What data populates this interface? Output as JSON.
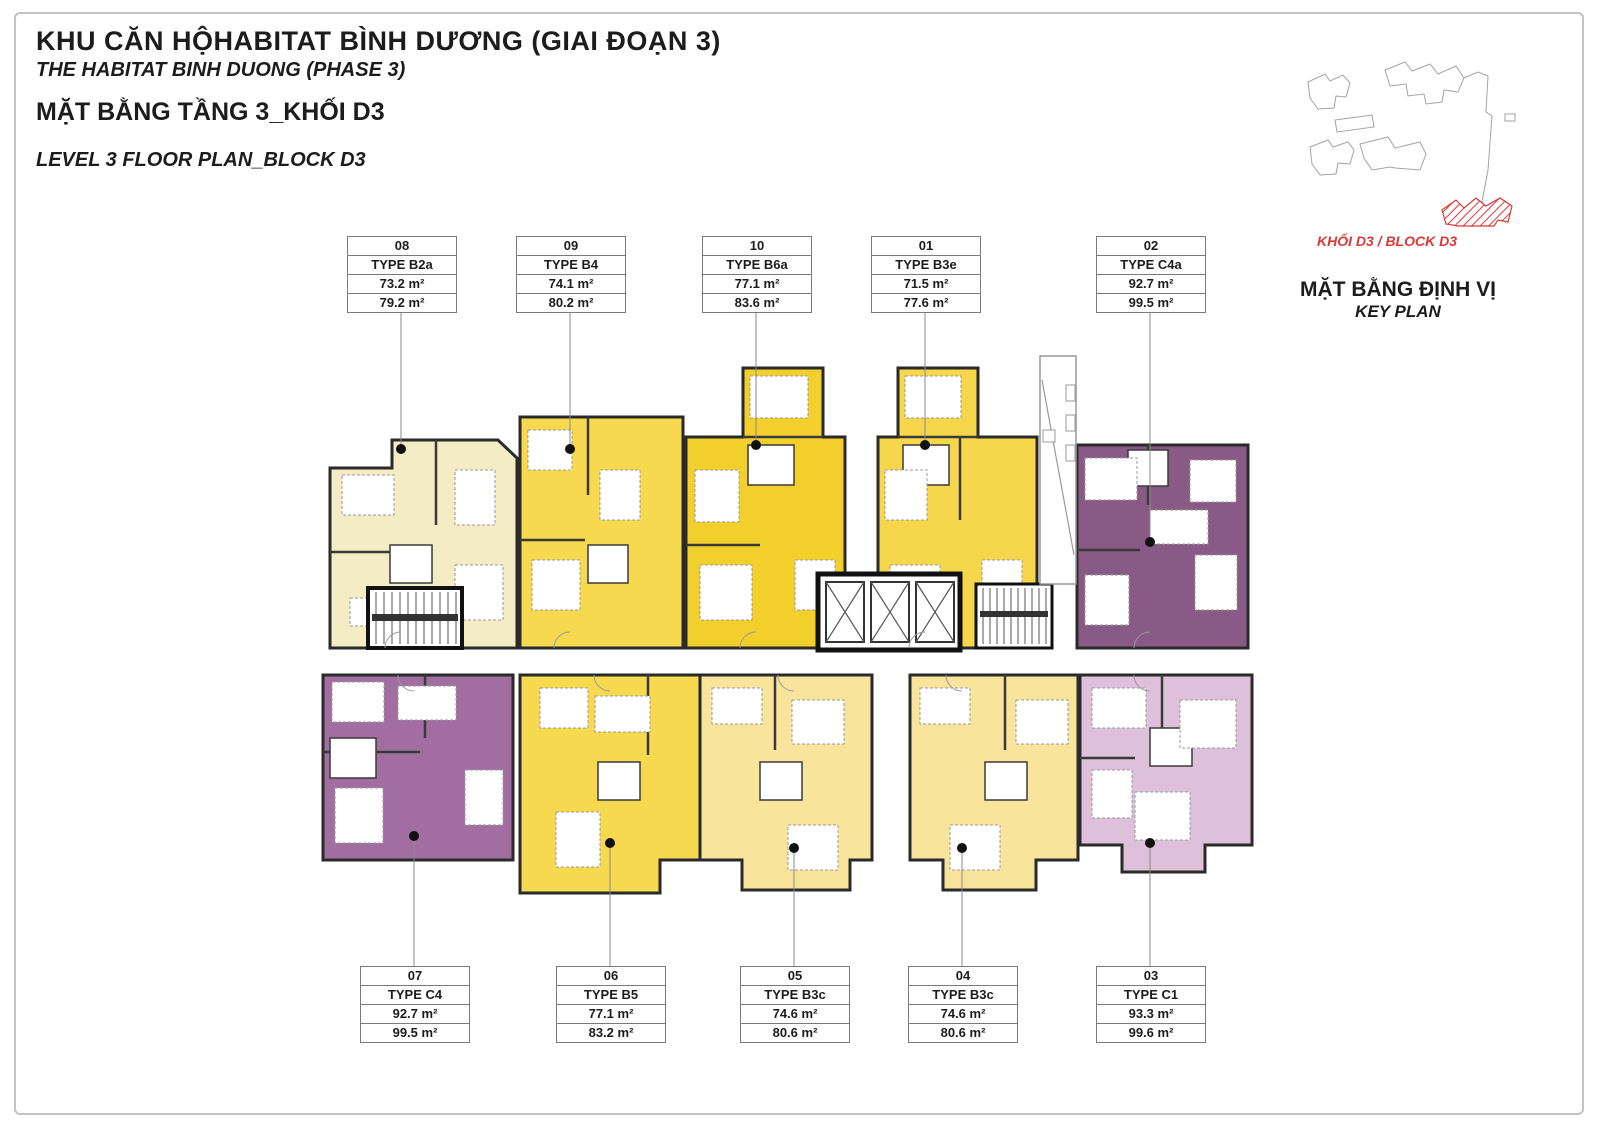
{
  "title": {
    "project_vi": "KHU CĂN HỘHABITAT BÌNH DƯƠNG (GIAI ĐOẠN 3)",
    "project_en": "THE HABITAT BINH DUONG (PHASE 3)",
    "plan_vi": "MẶT BẰNG TẦNG 3_KHỐI D3",
    "plan_en": "LEVEL 3 FLOOR PLAN_BLOCK D3"
  },
  "key_plan": {
    "block_label": "KHỐI D3 / BLOCK D3",
    "title_vi": "MẶT BẰNG ĐỊNH VỊ",
    "title_en": "KEY PLAN",
    "highlight_color": "#d93a36"
  },
  "units": [
    {
      "number": "08",
      "type": "TYPE B2a",
      "area_1": "73.2 m²",
      "area_2": "79.2 m²",
      "color": "#f4ecc4"
    },
    {
      "number": "09",
      "type": "TYPE B4",
      "area_1": "74.1 m²",
      "area_2": "80.2 m²",
      "color": "#f7d94f"
    },
    {
      "number": "10",
      "type": "TYPE B6a",
      "area_1": "77.1 m²",
      "area_2": "83.6 m²",
      "color": "#f2cf2a"
    },
    {
      "number": "01",
      "type": "TYPE B3e",
      "area_1": "71.5 m²",
      "area_2": "77.6 m²",
      "color": "#f6d64a"
    },
    {
      "number": "02",
      "type": "TYPE C4a",
      "area_1": "92.7 m²",
      "area_2": "99.5 m²",
      "color": "#8a5a86"
    },
    {
      "number": "07",
      "type": "TYPE C4",
      "area_1": "92.7 m²",
      "area_2": "99.5 m²",
      "color": "#a26da0"
    },
    {
      "number": "06",
      "type": "TYPE B5",
      "area_1": "77.1 m²",
      "area_2": "83.2 m²",
      "color": "#f7d94f"
    },
    {
      "number": "05",
      "type": "TYPE B3c",
      "area_1": "74.6 m²",
      "area_2": "80.6 m²",
      "color": "#f8e49b"
    },
    {
      "number": "04",
      "type": "TYPE B3c",
      "area_1": "74.6 m²",
      "area_2": "80.6 m²",
      "color": "#f8e49b"
    },
    {
      "number": "03",
      "type": "TYPE C1",
      "area_1": "93.3 m²",
      "area_2": "99.6 m²",
      "color": "#dec0db"
    }
  ]
}
